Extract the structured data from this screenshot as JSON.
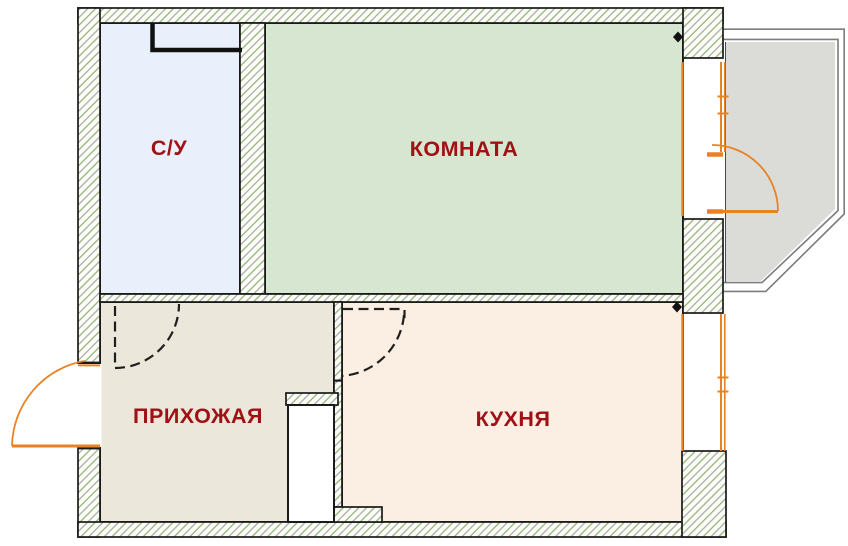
{
  "plan": {
    "type": "apartment-floor-plan",
    "background": "#ffffff",
    "label_color": "#a01115",
    "wall_edge_color": "#1a1a1a",
    "joinery_color": "#ea8222",
    "balcony_outline_color": "#7c7c7c",
    "hatch_line_colors": [
      "#99a294",
      "#84a763"
    ],
    "rooms": [
      {
        "id": "bathroom",
        "label": "С/У",
        "fill": "#e9effb"
      },
      {
        "id": "living-room",
        "label": "КОМНАТА",
        "fill": "#d6e6d0"
      },
      {
        "id": "hallway",
        "label": "ПРИХОЖАЯ",
        "fill": "#ebe7db"
      },
      {
        "id": "kitchen",
        "label": "КУХНЯ",
        "fill": "#fbeee3"
      },
      {
        "id": "balcony",
        "label": "",
        "fill": "#dbdbd8"
      }
    ],
    "features": [
      "entrance-door",
      "bathroom-door-swing",
      "kitchen-door-swing",
      "balcony-door",
      "balcony-window",
      "kitchen-window",
      "bathroom-duct-niche",
      "hallway-closet"
    ]
  }
}
